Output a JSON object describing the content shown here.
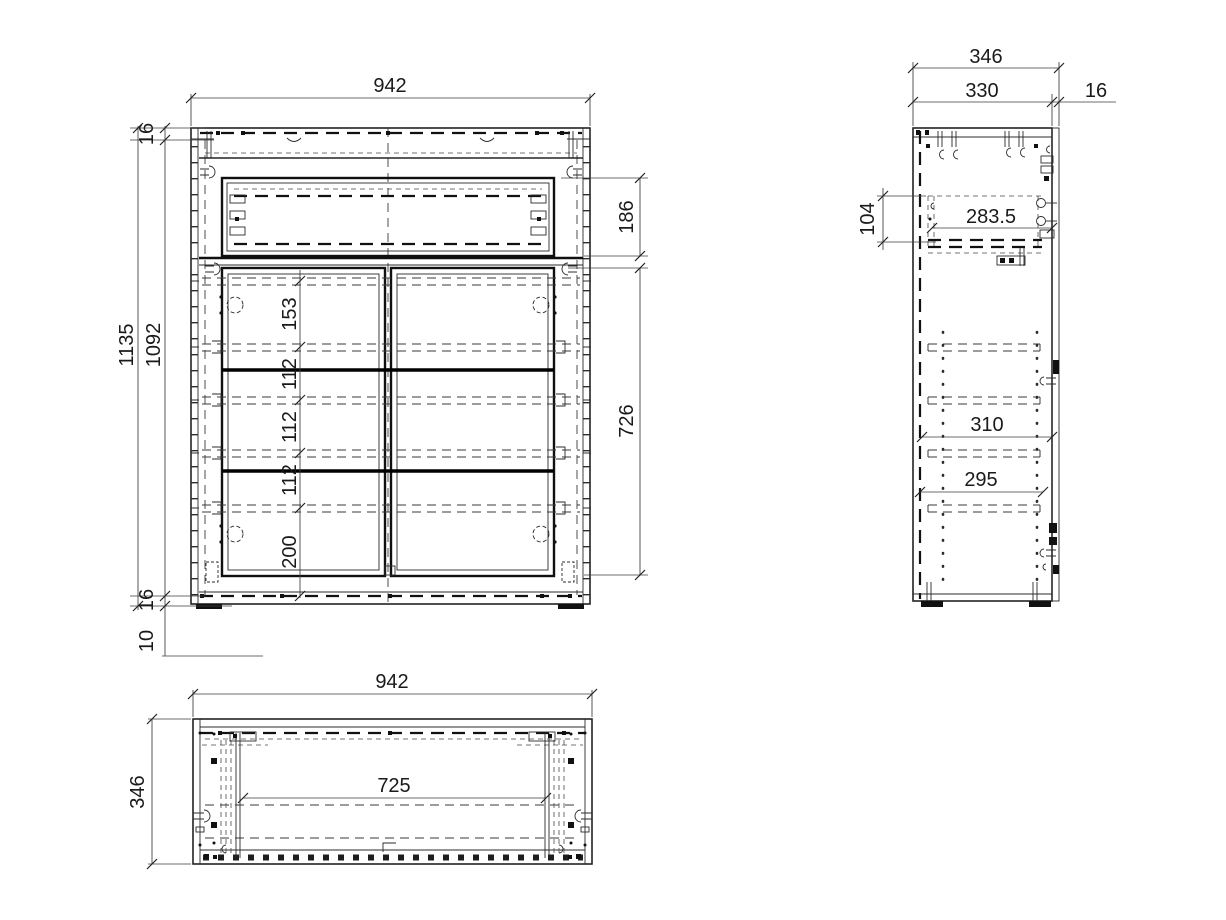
{
  "drawing": {
    "front_view": {
      "width": "942",
      "top_panel_thickness": "16",
      "total_height": "1135",
      "carcass_inner_height": "1092",
      "row_spacing_1": "153",
      "row_spacing_2": "112",
      "row_spacing_3": "112",
      "row_spacing_4": "112",
      "row_spacing_5": "200",
      "drawer_front_height": "186",
      "door_height": "726",
      "bottom_panel_thickness": "16",
      "foot_height": "10"
    },
    "side_view": {
      "total_depth": "346",
      "carcass_depth": "330",
      "front_thickness": "16",
      "drawer_side_height": "104",
      "drawer_depth": "283.5",
      "shelf_depth_upper": "310",
      "shelf_depth_lower": "295"
    },
    "top_view": {
      "width": "942",
      "depth": "346",
      "inner_width": "725"
    }
  }
}
